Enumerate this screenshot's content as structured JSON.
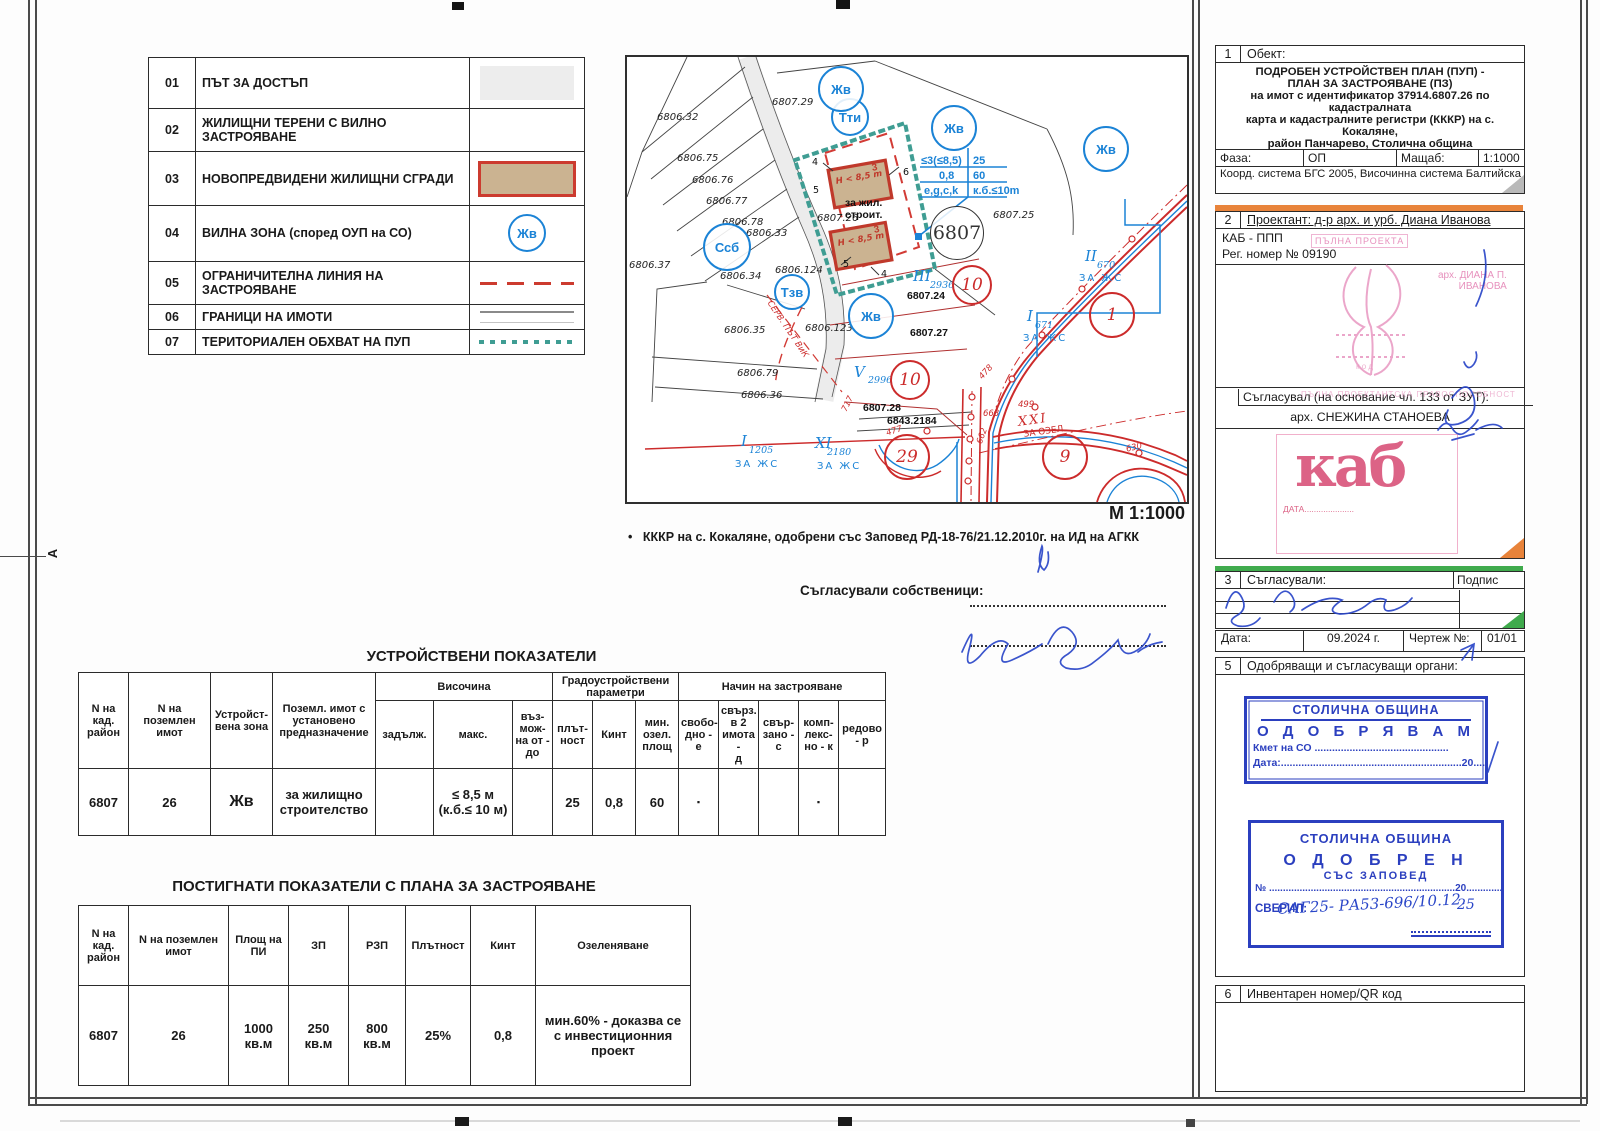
{
  "legend": {
    "rows": [
      {
        "num": "01",
        "label": "ПЪТ ЗА ДОСТЪП",
        "symbol": "road-band"
      },
      {
        "num": "02",
        "label": "ЖИЛИЩНИ ТЕРЕНИ С ВИЛНО ЗАСТРОЯВАНЕ",
        "symbol": "blank"
      },
      {
        "num": "03",
        "label": "НОВОПРЕДВИДЕНИ ЖИЛИЩНИ СГРАДИ",
        "symbol": "red-bordered-building"
      },
      {
        "num": "04",
        "label": "ВИЛНА ЗОНА (според ОУП на СО)",
        "symbol": "zone-circle",
        "symbol_text": "Жв"
      },
      {
        "num": "05",
        "label": "ОГРАНИЧИТЕЛНА ЛИНИЯ НА ЗАСТРОЯВАНЕ",
        "symbol": "red-dashed-line"
      },
      {
        "num": "06",
        "label": " ГРАНИЦИ НА ИМОТИ",
        "symbol": "property-border-line"
      },
      {
        "num": "07",
        "label": "ТЕРИТОРИАЛЕН ОБХВАТ НА ПУП",
        "symbol": "teal-dotted-line"
      }
    ]
  },
  "map": {
    "labels": [
      {
        "t": "6806.32",
        "x": 30,
        "y": 55,
        "c": "plbl"
      },
      {
        "t": "6806.75",
        "x": 50,
        "y": 96,
        "c": "plbl"
      },
      {
        "t": "6806.76",
        "x": 65,
        "y": 118,
        "c": "plbl"
      },
      {
        "t": "6806.77",
        "x": 79,
        "y": 139,
        "c": "plbl"
      },
      {
        "t": "6806.78",
        "x": 95,
        "y": 160,
        "c": "plbl"
      },
      {
        "t": "6806.33",
        "x": 119,
        "y": 171,
        "c": "plbl"
      },
      {
        "t": "6806.37",
        "x": 2,
        "y": 203,
        "c": "plbl"
      },
      {
        "t": "6806.34",
        "x": 93,
        "y": 214,
        "c": "plbl"
      },
      {
        "t": "6806.124",
        "x": 148,
        "y": 208,
        "c": "plbl"
      },
      {
        "t": "6806.35",
        "x": 97,
        "y": 268,
        "c": "plbl"
      },
      {
        "t": "6806.123",
        "x": 178,
        "y": 266,
        "c": "plbl"
      },
      {
        "t": "6806.79",
        "x": 110,
        "y": 311,
        "c": "plbl"
      },
      {
        "t": "6806.36",
        "x": 114,
        "y": 333,
        "c": "plbl"
      },
      {
        "t": "6807.29",
        "x": 145,
        "y": 40,
        "c": "plbl"
      },
      {
        "t": "6807.25",
        "x": 366,
        "y": 153,
        "c": "plbl"
      },
      {
        "t": "6807.24",
        "x": 280,
        "y": 233,
        "c": "pbold"
      },
      {
        "t": "6807.26",
        "x": 190,
        "y": 156,
        "c": "plbl"
      },
      {
        "t": "6807.27",
        "x": 283,
        "y": 270,
        "c": "pbold"
      },
      {
        "t": "6807.28",
        "x": 236,
        "y": 345,
        "c": "pbold"
      },
      {
        "t": "6843.2184",
        "x": 260,
        "y": 358,
        "c": "pbold"
      },
      {
        "t": "за жил.\nстроит.",
        "x": 218,
        "y": 140,
        "c": "pbold"
      },
      {
        "t": "СЕРВ. ПЪТ ВиК",
        "x": 146,
        "y": 242,
        "c": "rnum",
        "r": 56
      },
      {
        "t": "III",
        "x": 286,
        "y": 210,
        "c": "brom"
      },
      {
        "t": "2936",
        "x": 303,
        "y": 223,
        "c": "bsub"
      },
      {
        "t": "V",
        "x": 227,
        "y": 306,
        "c": "brom"
      },
      {
        "t": "2996",
        "x": 241,
        "y": 318,
        "c": "bsub"
      },
      {
        "t": "II",
        "x": 458,
        "y": 190,
        "c": "brom"
      },
      {
        "t": "670",
        "x": 470,
        "y": 203,
        "c": "bsub"
      },
      {
        "t": "ЗА ЖС",
        "x": 452,
        "y": 216,
        "c": "bzh"
      },
      {
        "t": "I",
        "x": 400,
        "y": 250,
        "c": "brom"
      },
      {
        "t": "671",
        "x": 408,
        "y": 263,
        "c": "bsub"
      },
      {
        "t": "ЗА ЖС",
        "x": 396,
        "y": 276,
        "c": "bzh"
      },
      {
        "t": "I",
        "x": 114,
        "y": 375,
        "c": "brom"
      },
      {
        "t": "1205",
        "x": 122,
        "y": 388,
        "c": "bsub"
      },
      {
        "t": "ЗА ЖС",
        "x": 108,
        "y": 402,
        "c": "bzh"
      },
      {
        "t": "XI",
        "x": 188,
        "y": 377,
        "c": "brom"
      },
      {
        "t": "2180",
        "x": 200,
        "y": 390,
        "c": "bsub"
      },
      {
        "t": "ЗА ЖС",
        "x": 190,
        "y": 404,
        "c": "bzh"
      },
      {
        "t": "XXI",
        "x": 390,
        "y": 358,
        "c": "rrom",
        "r": -8
      },
      {
        "t": "ЗА ОЗЕЛ.",
        "x": 396,
        "y": 373,
        "c": "rzh",
        "r": -8
      },
      {
        "t": "717",
        "x": 213,
        "y": 352,
        "c": "rnum",
        "r": -64
      },
      {
        "t": "477",
        "x": 258,
        "y": 372,
        "c": "rnum",
        "r": -18
      },
      {
        "t": "663",
        "x": 356,
        "y": 352,
        "c": "rnum"
      },
      {
        "t": "662",
        "x": 348,
        "y": 385,
        "c": "rnum",
        "r": -70
      },
      {
        "t": "499",
        "x": 391,
        "y": 343,
        "c": "rnum"
      },
      {
        "t": "478",
        "x": 350,
        "y": 318,
        "c": "rnum",
        "r": -48
      },
      {
        "t": "630",
        "x": 498,
        "y": 388,
        "c": "rnum",
        "r": -14
      },
      {
        "t": "≤3(≤8,5)",
        "x": 294,
        "y": 98,
        "c": "bind"
      },
      {
        "t": "25",
        "x": 346,
        "y": 98,
        "c": "bind"
      },
      {
        "t": "0,8",
        "x": 312,
        "y": 113,
        "c": "bind"
      },
      {
        "t": "60",
        "x": 346,
        "y": 113,
        "c": "bind"
      },
      {
        "t": "e,g,c,k",
        "x": 297,
        "y": 128,
        "c": "bind"
      },
      {
        "t": "к.б.≤10m",
        "x": 346,
        "y": 128,
        "c": "bind"
      },
      {
        "t": "3",
        "x": 244,
        "y": 106,
        "c": "bred",
        "r": -10
      },
      {
        "t": "H < 8,5 m",
        "x": 208,
        "y": 120,
        "c": "bredi",
        "r": -10
      },
      {
        "t": "3",
        "x": 246,
        "y": 168,
        "c": "bred",
        "r": -10
      },
      {
        "t": "H < 8,5 m",
        "x": 210,
        "y": 182,
        "c": "bredi",
        "r": -10
      },
      {
        "t": "4",
        "x": 185,
        "y": 100,
        "c": "dim"
      },
      {
        "t": "5",
        "x": 186,
        "y": 128,
        "c": "dim"
      },
      {
        "t": "6",
        "x": 276,
        "y": 110,
        "c": "dim"
      },
      {
        "t": "5",
        "x": 216,
        "y": 202,
        "c": "dim"
      },
      {
        "t": "4",
        "x": 254,
        "y": 212,
        "c": "dim"
      }
    ],
    "circles": [
      {
        "t": "Тти",
        "x": 223,
        "y": 60,
        "d": 34,
        "c": "blue"
      },
      {
        "t": "Ссб",
        "x": 100,
        "y": 190,
        "d": 44,
        "c": "blue"
      },
      {
        "t": "Тзв",
        "x": 165,
        "y": 235,
        "d": 32,
        "c": "blue"
      },
      {
        "t": "Жв",
        "x": 214,
        "y": 32,
        "d": 42,
        "c": "blue"
      },
      {
        "t": "Жв",
        "x": 327,
        "y": 71,
        "d": 42,
        "c": "blue"
      },
      {
        "t": "Жв",
        "x": 479,
        "y": 92,
        "d": 42,
        "c": "blue"
      },
      {
        "t": "Жв",
        "x": 244,
        "y": 259,
        "d": 42,
        "c": "blue"
      },
      {
        "t": "6807",
        "x": 330,
        "y": 176,
        "d": 52,
        "c": "blk"
      },
      {
        "t": "10",
        "x": 345,
        "y": 228,
        "d": 36,
        "c": "red"
      },
      {
        "t": "10",
        "x": 283,
        "y": 323,
        "d": 36,
        "c": "red"
      },
      {
        "t": "1",
        "x": 485,
        "y": 258,
        "d": 42,
        "c": "red"
      },
      {
        "t": "29",
        "x": 280,
        "y": 400,
        "d": 42,
        "c": "red"
      },
      {
        "t": "9",
        "x": 438,
        "y": 400,
        "d": 42,
        "c": "red"
      }
    ]
  },
  "map_footer": {
    "scale": "М 1:1000",
    "bullet": "•",
    "note": "КККР на  с. Кокаляне, одобрени със Заповед РД-18-76/21.12.2010г. на ИД на АГКК",
    "owners": "Съгласували собственици:"
  },
  "table1": {
    "title": "УСТРОЙСТВЕНИ ПОКАЗАТЕЛИ",
    "h_kad": "N на\nкад.\nрайон",
    "h_imot": "N на поземлен\nимот",
    "h_zone": "Устройст-\nвена зона",
    "h_naznach": "Поземл. имот с\nустановено\nпредназначение",
    "g_height": "Височина",
    "h_zadalj": "задълж.",
    "h_maks": "макс.",
    "h_vazm": "въз-\nмож-\nна от -\nдо",
    "g_grado": "Градоустройствени\nпараметри",
    "h_plat": "плът-\nност",
    "h_kint": "Кинт",
    "h_ozel": "мин.\nозел.\nплощ",
    "g_nachin": "Начин на застрояване",
    "h_svob": "свобо-\nдно -\nе",
    "h_sv2": "свърз.\nв 2\nимота -\nд",
    "h_svz": "свър-\nзано -\nс",
    "h_komp": "комп-\nлекс-\nно - к",
    "h_red": "редово\n- р",
    "row": {
      "kad": "6807",
      "imot": "26",
      "zone": "Жв",
      "naznach": "за жилищно\nстроителство",
      "zadalj": "",
      "maks": "≤ 8,5 м\n(к.б.≤ 10 м)",
      "vazm": "",
      "plat": "25",
      "kint": "0,8",
      "ozel": "60",
      "svob": "▪",
      "sv2": "",
      "svz": "",
      "komp": "▪",
      "red": ""
    }
  },
  "table2": {
    "title": "ПОСТИГНАТИ ПОКАЗАТЕЛИ С ПЛАНА ЗА ЗАСТРОЯВАНЕ",
    "h_kad": "N на\nкад.\nрайон",
    "h_imot": "N на поземлен\nимот",
    "h_plosht": "Площ на\nПИ",
    "h_zp": "ЗП",
    "h_rzp": "РЗП",
    "h_plat": "Плътност",
    "h_kint": "Кинт",
    "h_ozel": "Озеленяване",
    "row": {
      "kad": "6807",
      "imot": "26",
      "plosht": "1000\nкв.м",
      "zp": "250\nкв.м",
      "rzp": "800\nкв.м",
      "plat": "25%",
      "kint": "0,8",
      "ozel": "мин.60% - доказва се\nс инвестиционния\nпроект"
    }
  },
  "sidebar": {
    "panel1": {
      "num": "1",
      "label": "Обект:",
      "title": "ПОДРОБЕН УСТРОЙСТВЕН ПЛАН (ПУП) -\nПЛАН ЗА ЗАСТРОЯВАНЕ (ПЗ)\nна имот с идентификатор 37914.6807.26 по кадастралната\nкарта и кадастралните регистри (КККР) на с. Кокаляне,\nрайон Панчарево, Столична община",
      "faza_label": "Фаза:",
      "faza": "ОП",
      "mashtab_label": "Мащаб:",
      "mashtab": "1:1000",
      "coords": "Коорд. система БГС 2005, Височинна система Балтийска"
    },
    "panel2": {
      "num": "2",
      "label": "Проектант: д-р арх. и урб. Диана Иванова",
      "org": "КАБ - ППП",
      "reg": "Рег. номер № 09190",
      "stamp_small": "ПЪЛНА ПРОЕКТА",
      "arch_name": "арх. ДИАНА П.\nИВАНОВА",
      "stamp_faint": "ПЪЛНА ПРОЕКТАНТСКА ПРАВОСПОСОБНОСТ",
      "saglasuval": "Съгласувал (на основание чл. 133 от ЗУТ):",
      "arch2": "арх. СНЕЖИНА СТАНОЕВА",
      "kab_logo": "каб",
      "kab_date": "ДАТА....................."
    },
    "panel3": {
      "num": "3",
      "label": "Съгласували:",
      "podpis": "Подпис"
    },
    "daterow": {
      "data_label": "Дата:",
      "data": "09.2024 г.",
      "chertej_label": "Чертеж №:",
      "chertej": "01/01"
    },
    "panel5": {
      "num": "5",
      "label": "Одобряващи и съгласуващи органи:",
      "stamp1": {
        "l1": "СТОЛИЧНА ОБЩИНА",
        "l2": "О Д О Б Р Я В А М",
        "l3": "Кмет на СО ..............................................",
        "l4": "Дата:..............................................................20...............г."
      },
      "stamp2": {
        "l1": "СТОЛИЧНА ОБЩИНА",
        "l2": "О Д О Б Р Е Н",
        "l3": "СЪС ЗАПОВЕД",
        "num_prefix": "№",
        "base": "...................................................................20..............г.",
        "hand": "САГ25- РА53-696/10.12.",
        "hand_year": "25",
        "sveril": "СВЕРИЛ:"
      }
    },
    "panel6": {
      "num": "6",
      "label": "Инвентарен номер/QR код"
    }
  },
  "edge": {
    "fold_marker": "A"
  },
  "colors": {
    "map_blue": "#1b83d6",
    "map_red": "#cc2b2b",
    "teal": "#3f9d93",
    "building_fill": "#cbb391",
    "stamp_blue": "#2b3fbf",
    "kab_pink": "#d9537a",
    "pale_pink": "#e791bd",
    "accent_orange": "#e8833a",
    "accent_green": "#3faa4c"
  }
}
